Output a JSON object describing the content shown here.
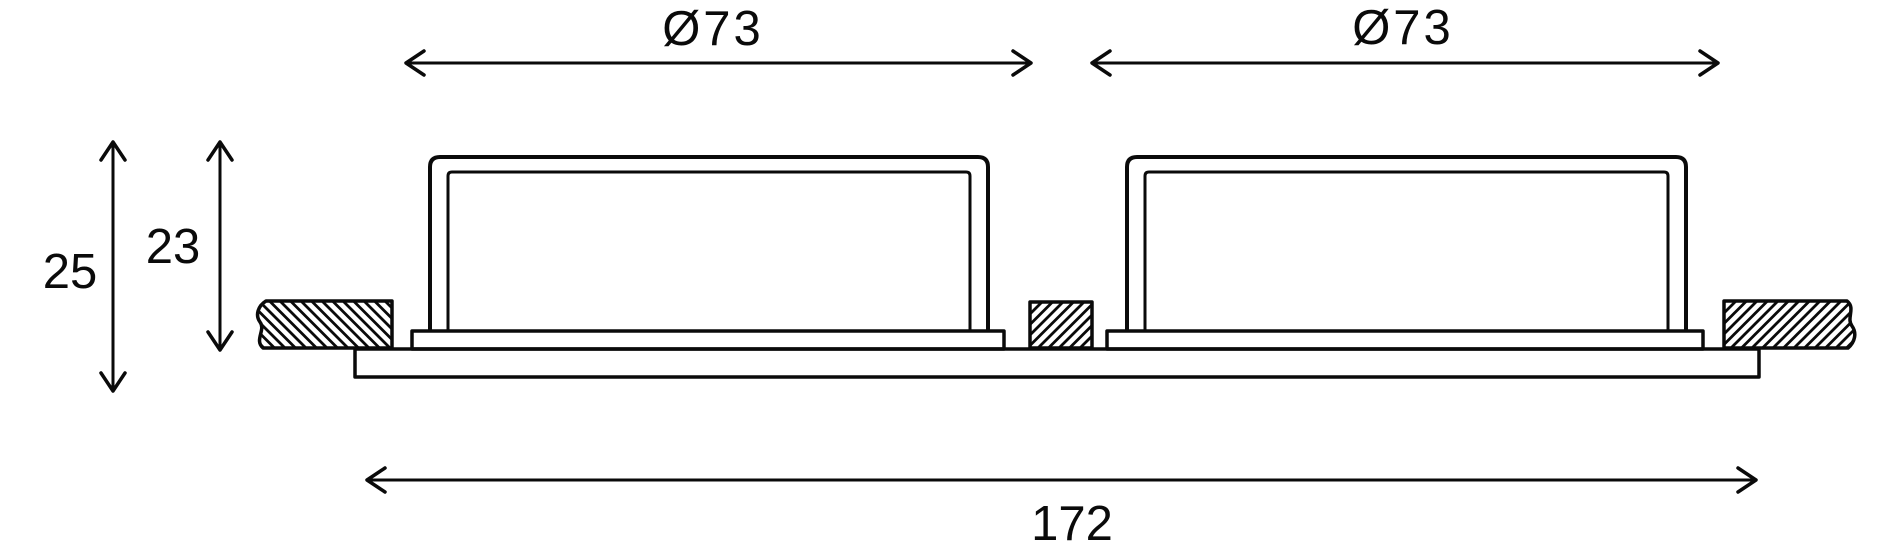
{
  "colors": {
    "ink": "#0a0a0a",
    "background": "#ffffff"
  },
  "dimensions": {
    "diameter_left": {
      "label": "Ø73",
      "value": 73
    },
    "diameter_right": {
      "label": "Ø73",
      "value": 73
    },
    "overall_height": {
      "label": "25",
      "value": 25
    },
    "recess_height": {
      "label": "23",
      "value": 23
    },
    "overall_width": {
      "label": "172",
      "value": 172
    }
  }
}
